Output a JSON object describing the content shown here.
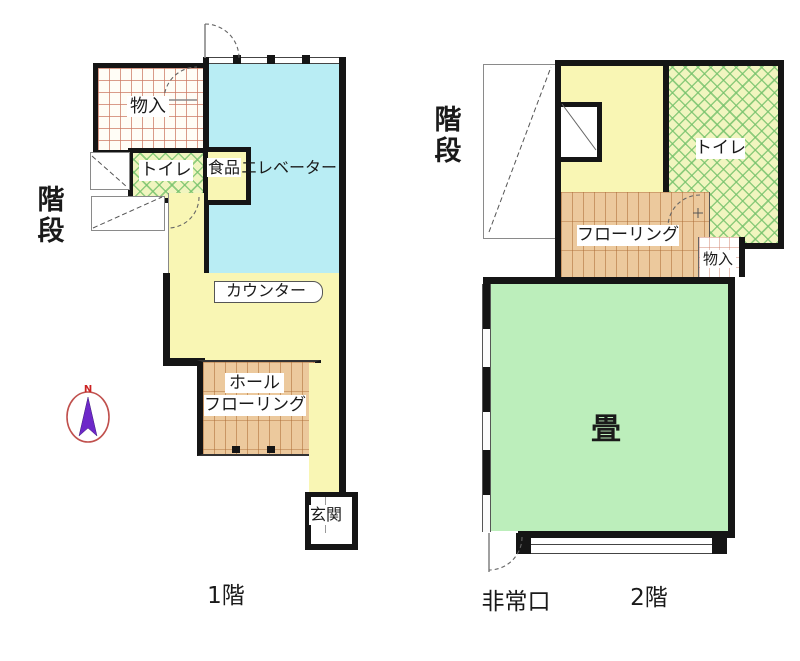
{
  "document": {
    "type": "floor-plan",
    "background_color": "#ffffff",
    "wall_color": "#151515"
  },
  "colors": {
    "yellow_room": "#f9f6b4",
    "cyan_room": "#b9edf4",
    "tatami_green": "#bceebb",
    "wood_floor": "#ecc99d",
    "toilet_lattice_bg": "#f1f5bf",
    "compass_arrow": "#6d28c9",
    "compass_ring": "#c0504d"
  },
  "floor1": {
    "title": "1階",
    "stairs_label": "階段",
    "storage_label": "物入",
    "toilet_label": "トイレ",
    "food_elevator_label_part1": "食品",
    "food_elevator_label_part2": "エレベーター",
    "counter_label": "カウンター",
    "hall_label_line1": "ホール",
    "hall_label_line2": "フローリング",
    "entrance_label": "玄関",
    "compass_north": "N"
  },
  "floor2": {
    "title": "2階",
    "stairs_label": "階段",
    "toilet_label": "トイレ",
    "flooring_label": "フローリング",
    "storage_label": "物入",
    "tatami_label": "畳",
    "emergency_exit_label": "非常口"
  }
}
